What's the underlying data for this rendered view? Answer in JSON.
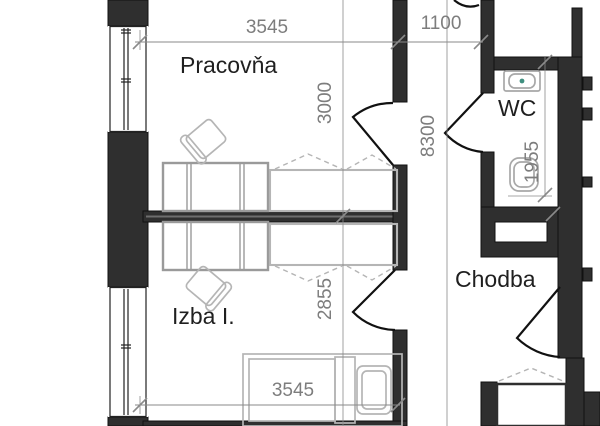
{
  "plan": {
    "type": "architectural-floor-plan",
    "rooms": [
      {
        "id": "pracovna",
        "label": "Pracovňa"
      },
      {
        "id": "izba",
        "label": "Izba I."
      },
      {
        "id": "wc",
        "label": "WC"
      },
      {
        "id": "chodba",
        "label": "Chodba"
      }
    ],
    "dims": {
      "top_room_width": "3545",
      "corridor_width": "1100",
      "pracovna_depth": "3000",
      "total_depth": "8300",
      "izba_depth": "2855",
      "wc_depth": "1955",
      "bottom_room_width": "3545"
    },
    "colors": {
      "wall": "#2f2f2f",
      "wall_core": "#6e6e6e",
      "dim": "#7d7d7d",
      "dim_line": "#8a8a8a",
      "label": "#1f1f1f",
      "furniture_mid": "#9a9a9a",
      "furniture_light": "#b5b5b5",
      "basin_dot": "#3f8f7f"
    }
  }
}
